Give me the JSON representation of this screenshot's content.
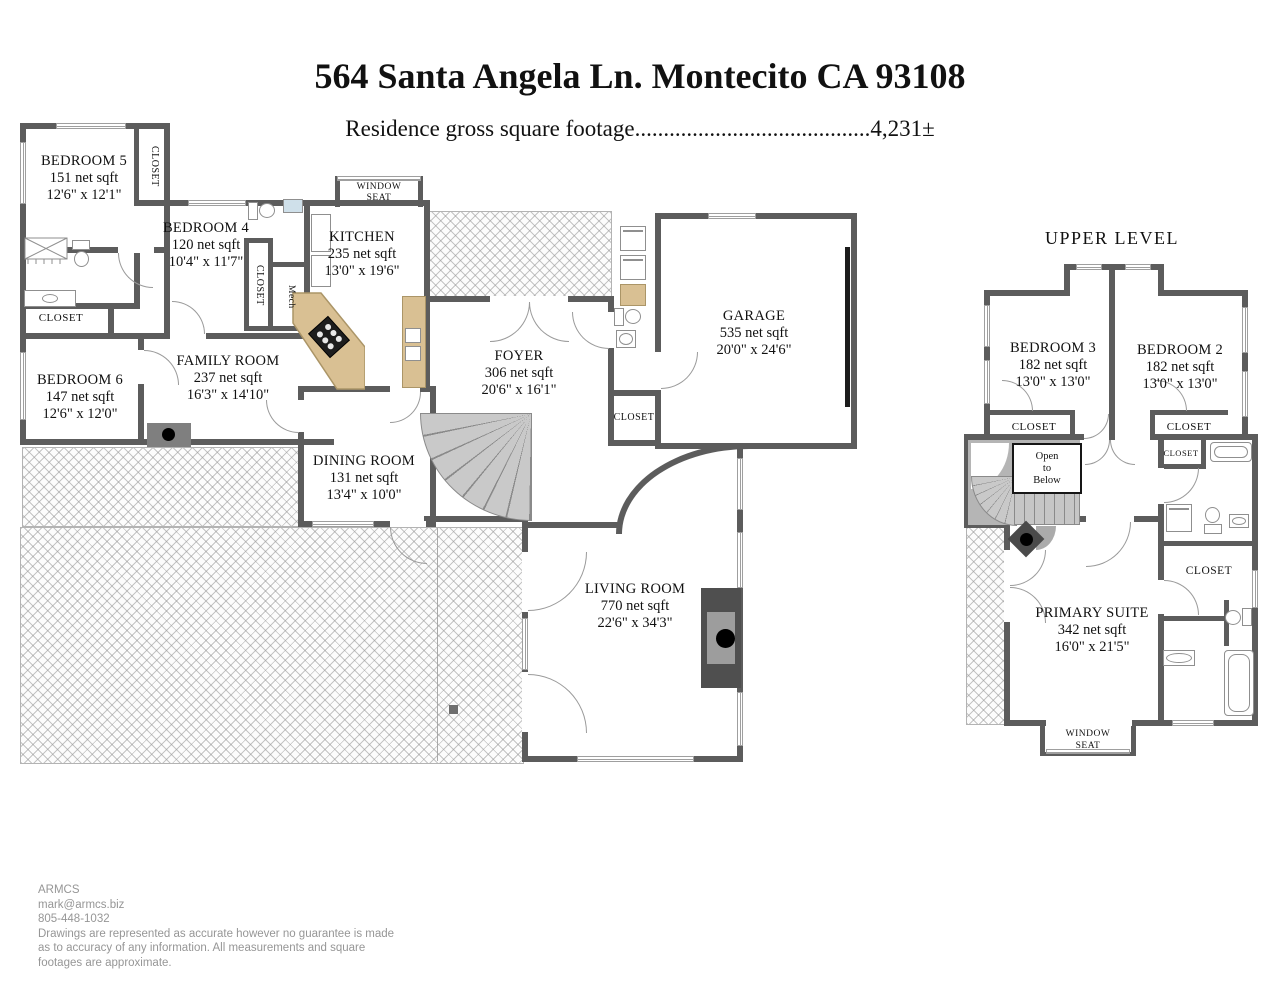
{
  "header": {
    "title": "564 Santa Angela Ln. Montecito CA 93108",
    "subtitle": "Residence gross square footage.........................................4,231±",
    "upper_level": "UPPER LEVEL"
  },
  "rooms": {
    "bedroom5": {
      "name": "BEDROOM 5",
      "area": "151 net sqft",
      "dims": "12'6\" x 12'1\""
    },
    "bedroom4": {
      "name": "BEDROOM 4",
      "area": "120 net sqft",
      "dims": "10'4\" x 11'7\""
    },
    "kitchen": {
      "name": "KITCHEN",
      "area": "235 net sqft",
      "dims": "13'0\" x 19'6\""
    },
    "family": {
      "name": "FAMILY ROOM",
      "area": "237 net sqft",
      "dims": "16'3\" x 14'10\""
    },
    "bedroom6": {
      "name": "BEDROOM 6",
      "area": "147 net sqft",
      "dims": "12'6\" x 12'0\""
    },
    "dining": {
      "name": "DINING ROOM",
      "area": "131 net sqft",
      "dims": "13'4\" x 10'0\""
    },
    "foyer": {
      "name": "FOYER",
      "area": "306 net sqft",
      "dims": "20'6\" x 16'1\""
    },
    "garage": {
      "name": "GARAGE",
      "area": "535 net sqft",
      "dims": "20'0\" x 24'6\""
    },
    "living": {
      "name": "LIVING ROOM",
      "area": "770 net sqft",
      "dims": "22'6\" x 34'3\""
    },
    "bedroom3": {
      "name": "BEDROOM 3",
      "area": "182 net sqft",
      "dims": "13'0\" x 13'0\""
    },
    "bedroom2": {
      "name": "BEDROOM 2",
      "area": "182 net sqft",
      "dims": "13'0\" x 13'0\""
    },
    "primary": {
      "name": "PRIMARY SUITE",
      "area": "342 net sqft",
      "dims": "16'0\" x 21'5\""
    }
  },
  "labels": {
    "closet": "CLOSET",
    "mech": "Mech",
    "window": "WINDOW",
    "seat": "SEAT",
    "open1": "Open",
    "open2": "to",
    "open3": "Below"
  },
  "footer": {
    "company": "ARMCS",
    "email": "mark@armcs.biz",
    "phone": "805-448-1032",
    "disclaimer1": "Drawings are represented as accurate however no guarantee is made",
    "disclaimer2": "as to accuracy of any information. All measurements and square",
    "disclaimer3": "footages are approximate."
  },
  "colors": {
    "wall": "#5c5c5c",
    "counter": "#d9c093",
    "stair": "#c9c9c9"
  }
}
